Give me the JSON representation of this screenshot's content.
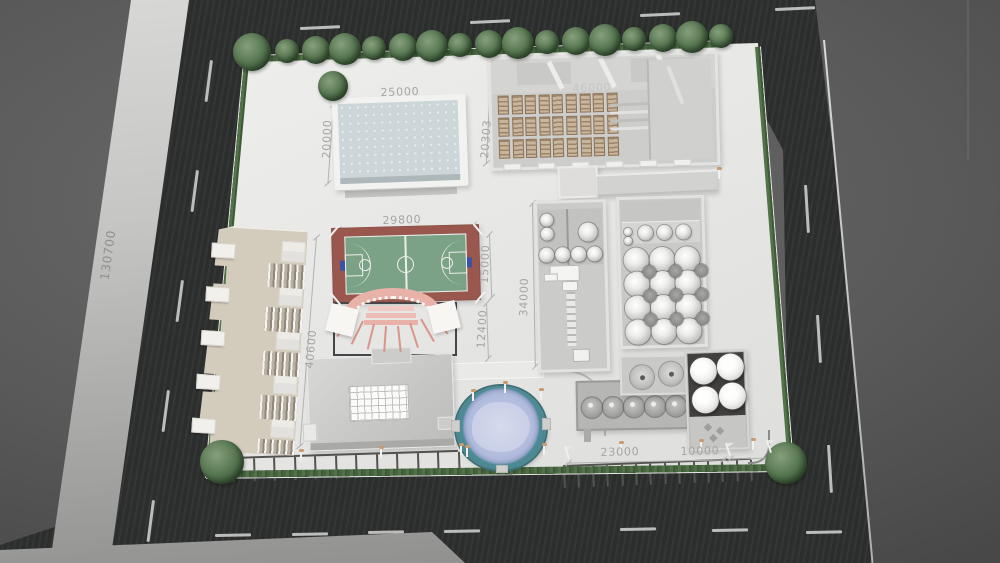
{
  "scene": {
    "description": "aerial 3d site plan render of a walled factory campus surrounded by roads",
    "colors": {
      "road": "#2e302f",
      "background": "#565656",
      "site_ground": "#e5e5e3",
      "hedge_green": "#48663f",
      "tree_green": "#4e6f48",
      "court_surround": "#99574e",
      "court_surface": "#7ba287",
      "pool_water": "#cdd7d9",
      "pond_rim": "#4e8b95",
      "pond_water": "#b0badc",
      "stage_pink": "#e8b2a9",
      "office_tan": "#d4ccbd",
      "crate_tan": "#c9b49c",
      "lane_marking": "#c6c6c4",
      "dimension_text": "#a5a5a3"
    }
  },
  "dimensions": {
    "site_length": "130700",
    "pool_width": "25000",
    "pool_depth": "20000",
    "warehouse_depth": "20303",
    "warehouse_width": "46000",
    "court_width": "29800",
    "court_depth": "15000",
    "stage_depth": "12400",
    "workshop_depth": "34000",
    "office_length": "40600",
    "parking_width": "23000",
    "tank_yard_width": "10000"
  },
  "equipment": {
    "roadside_trees": 16,
    "corner_trees": [
      [
        252,
        52,
        38
      ],
      [
        333,
        86,
        30
      ],
      [
        222,
        462,
        44
      ],
      [
        786,
        463,
        42
      ]
    ],
    "warehouse_pallet_columns": 9,
    "warehouse_pallet_rows": 3,
    "warehouse_dock_doors": 6,
    "tank_hall_rows": 4,
    "tank_hall_columns": 3,
    "tank_hall_shelf_tanks": 3,
    "prep_room_small_tanks": 4,
    "yard_round_tanks": 5,
    "yard_funnel_tanks": 2,
    "storage_silos": 4,
    "parking_stalls_left": 11,
    "parking_stalls_right": 13
  }
}
